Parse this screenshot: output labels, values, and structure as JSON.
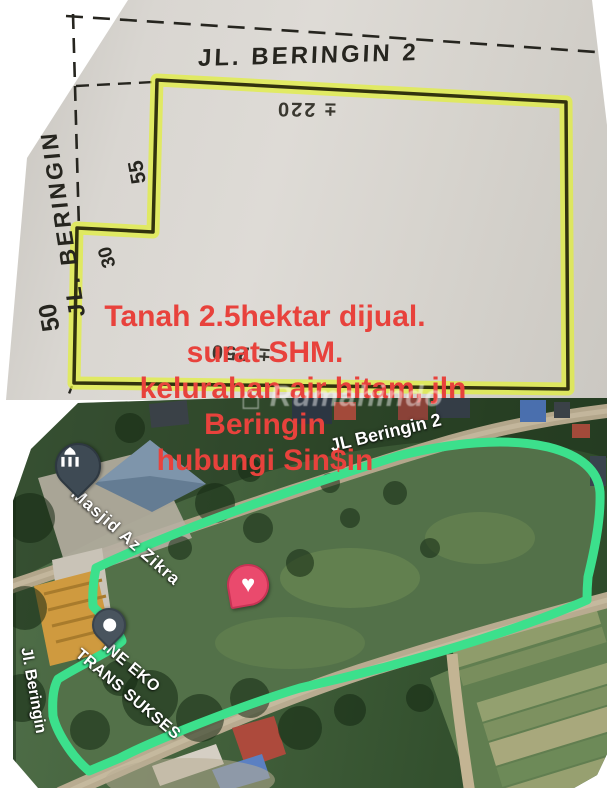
{
  "sketch": {
    "top_road_label": "JL. BERINGIN 2",
    "left_road_label": "JL. BERINGIN",
    "dims": {
      "left_upper": "55",
      "step": "30",
      "left_lower": "50",
      "top": "± 220",
      "bottom": "± 250"
    },
    "highlight_color": "#e2ef3e"
  },
  "overlay": {
    "color": "#e8423c",
    "lines": [
      "Tanah 2.5hektar dijual.",
      "surat SHM.",
      "kelurahan air hitam, jln",
      "Beringin",
      "hubungi Sin$in"
    ]
  },
  "watermark": {
    "text": "Rumahindo",
    "house_glyph": "⌂"
  },
  "map": {
    "boundary_color": "#3ce08c",
    "labels": {
      "top_road": "JL Beringin 2",
      "mosque": "Masjid Az Zikra",
      "business_line1": "INE EKO",
      "business_line2": "TRANS SUKSES",
      "left_road": "Jl. Beringin"
    },
    "pins": {
      "mosque": "mosque-pin",
      "saved_place": "heart-pin",
      "place": "place-pin"
    },
    "heart_glyph": "♥"
  }
}
